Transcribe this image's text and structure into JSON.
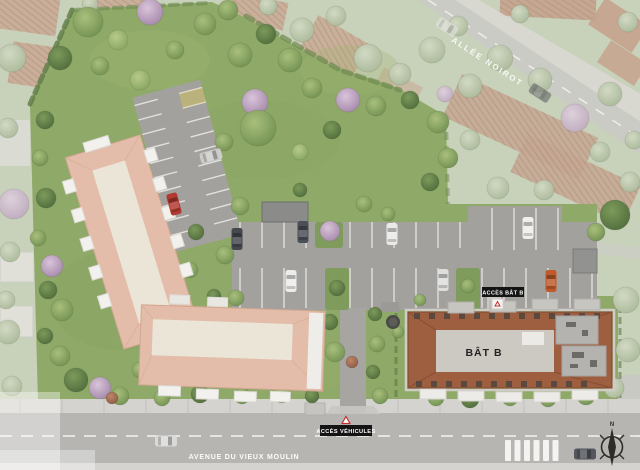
{
  "meta": {
    "kind": "aerial-residence-site-plan"
  },
  "labels": {
    "street_top": "ALLÉE NOIROT",
    "street_bottom": "AVENUE DU VIEUX MOULIN",
    "access_building_b": "ACCÈS BÂT B",
    "access_vehicles": "ACCÈS VÉHICULES",
    "building_b": "BÂT B",
    "compass_north": "N"
  },
  "colors": {
    "vivid_grass": "#8fa968",
    "washed_grass": "#c8d1b9",
    "building_a_roof": "#e3bdaa",
    "building_b_roof": "#9e5f40",
    "asphalt": "#a2a19e",
    "road": "#b6b5b2",
    "label_background": "#141414",
    "label_text": "#ffffff"
  },
  "decor": {
    "trees": [
      [
        12,
        58,
        14,
        "w"
      ],
      [
        8,
        128,
        10,
        "w"
      ],
      [
        14,
        204,
        15,
        "wp"
      ],
      [
        10,
        252,
        10,
        "w"
      ],
      [
        6,
        300,
        9,
        "w"
      ],
      [
        8,
        332,
        12,
        "w"
      ],
      [
        12,
        386,
        10,
        "w"
      ],
      [
        90,
        4,
        8,
        "w"
      ],
      [
        268,
        6,
        9,
        "w"
      ],
      [
        302,
        30,
        12,
        "w"
      ],
      [
        336,
        16,
        10,
        "w"
      ],
      [
        368,
        58,
        14,
        "w"
      ],
      [
        400,
        74,
        11,
        "w"
      ],
      [
        432,
        50,
        13,
        "w"
      ],
      [
        458,
        26,
        10,
        "w"
      ],
      [
        470,
        86,
        12,
        "w"
      ],
      [
        500,
        58,
        13,
        "w"
      ],
      [
        540,
        80,
        12,
        "w"
      ],
      [
        575,
        118,
        14,
        "wp"
      ],
      [
        610,
        94,
        12,
        "w"
      ],
      [
        600,
        152,
        10,
        "w"
      ],
      [
        634,
        140,
        9,
        "w"
      ],
      [
        470,
        140,
        10,
        "w"
      ],
      [
        498,
        188,
        11,
        "w"
      ],
      [
        544,
        190,
        10,
        "w"
      ],
      [
        628,
        22,
        10,
        "w"
      ],
      [
        520,
        14,
        9,
        "w"
      ],
      [
        445,
        94,
        8,
        "wp"
      ],
      [
        630,
        182,
        10,
        "w"
      ],
      [
        614,
        388,
        10,
        "w"
      ],
      [
        628,
        350,
        12,
        "w"
      ],
      [
        626,
        300,
        13,
        "w"
      ],
      [
        88,
        22,
        15,
        "g"
      ],
      [
        118,
        40,
        10,
        "gl"
      ],
      [
        150,
        12,
        13,
        "p"
      ],
      [
        60,
        58,
        12,
        "gd"
      ],
      [
        100,
        66,
        9,
        "g"
      ],
      [
        140,
        80,
        10,
        "gl"
      ],
      [
        175,
        50,
        9,
        "g"
      ],
      [
        205,
        24,
        11,
        "g"
      ],
      [
        228,
        10,
        10,
        "g"
      ],
      [
        255,
        102,
        13,
        "p"
      ],
      [
        348,
        100,
        12,
        "p"
      ],
      [
        240,
        55,
        12,
        "g"
      ],
      [
        266,
        34,
        10,
        "gd"
      ],
      [
        290,
        60,
        12,
        "g"
      ],
      [
        312,
        88,
        10,
        "g"
      ],
      [
        258,
        128,
        18,
        "g"
      ],
      [
        300,
        152,
        8,
        "gl"
      ],
      [
        224,
        142,
        9,
        "g"
      ],
      [
        332,
        130,
        9,
        "gd"
      ],
      [
        376,
        106,
        10,
        "g"
      ],
      [
        410,
        100,
        9,
        "gd"
      ],
      [
        438,
        122,
        11,
        "g"
      ],
      [
        448,
        158,
        10,
        "g"
      ],
      [
        430,
        182,
        9,
        "gd"
      ],
      [
        45,
        120,
        9,
        "gd"
      ],
      [
        40,
        158,
        8,
        "g"
      ],
      [
        46,
        198,
        10,
        "gd"
      ],
      [
        38,
        238,
        8,
        "g"
      ],
      [
        52,
        266,
        11,
        "p"
      ],
      [
        48,
        290,
        9,
        "gd"
      ],
      [
        62,
        310,
        11,
        "g"
      ],
      [
        45,
        336,
        8,
        "gd"
      ],
      [
        60,
        356,
        10,
        "g"
      ],
      [
        76,
        380,
        12,
        "gd"
      ],
      [
        100,
        388,
        11,
        "p"
      ],
      [
        120,
        396,
        9,
        "g"
      ],
      [
        140,
        370,
        8,
        "g"
      ],
      [
        162,
        398,
        8,
        "g"
      ],
      [
        200,
        394,
        9,
        "gd"
      ],
      [
        242,
        396,
        8,
        "g"
      ],
      [
        282,
        394,
        9,
        "g"
      ],
      [
        312,
        396,
        7,
        "gd"
      ],
      [
        335,
        352,
        10,
        "g"
      ],
      [
        330,
        322,
        8,
        "gd"
      ],
      [
        190,
        270,
        8,
        "g"
      ],
      [
        214,
        296,
        7,
        "gd"
      ],
      [
        236,
        298,
        8,
        "g"
      ],
      [
        112,
        398,
        6,
        "rb"
      ],
      [
        352,
        362,
        6,
        "rb"
      ],
      [
        240,
        206,
        9,
        "g"
      ],
      [
        330,
        231,
        10,
        "p"
      ],
      [
        388,
        214,
        7,
        "g"
      ],
      [
        364,
        204,
        8,
        "g"
      ],
      [
        300,
        190,
        7,
        "gd"
      ],
      [
        337,
        288,
        8,
        "gd"
      ],
      [
        468,
        286,
        7,
        "g"
      ],
      [
        225,
        255,
        9,
        "g"
      ],
      [
        196,
        232,
        8,
        "gd"
      ],
      [
        375,
        314,
        7,
        "gd"
      ],
      [
        377,
        344,
        8,
        "g"
      ],
      [
        373,
        372,
        7,
        "gd"
      ],
      [
        380,
        396,
        8,
        "g"
      ],
      [
        398,
        332,
        6,
        "g"
      ],
      [
        420,
        300,
        6,
        "g"
      ],
      [
        436,
        398,
        8,
        "g"
      ],
      [
        470,
        399,
        9,
        "gd"
      ],
      [
        510,
        398,
        8,
        "g"
      ],
      [
        548,
        399,
        8,
        "g"
      ],
      [
        586,
        396,
        9,
        "g"
      ],
      [
        615,
        215,
        15,
        "gd"
      ],
      [
        596,
        232,
        9,
        "g"
      ]
    ],
    "cars": [
      [
        303,
        232,
        0,
        "#4b4f56",
        0
      ],
      [
        392,
        234,
        0,
        "#e9e9e7",
        0
      ],
      [
        528,
        228,
        0,
        "#f0efec",
        0
      ],
      [
        291,
        281,
        0,
        "#ececea",
        0
      ],
      [
        443,
        280,
        0,
        "#dededc",
        0
      ],
      [
        551,
        281,
        0,
        "#c05a2a",
        0
      ],
      [
        237,
        239,
        0,
        "#45484e",
        0
      ],
      [
        174,
        204,
        -15,
        "#b23a30",
        0
      ],
      [
        211,
        156,
        75,
        "#cccccb",
        0
      ],
      [
        166,
        441,
        90,
        "#dadad8",
        0
      ],
      [
        585,
        454,
        90,
        "#54575d",
        0
      ],
      [
        447,
        27,
        123,
        "#e8e7e5",
        1
      ],
      [
        540,
        93,
        123,
        "#5a5d63",
        1
      ]
    ]
  }
}
